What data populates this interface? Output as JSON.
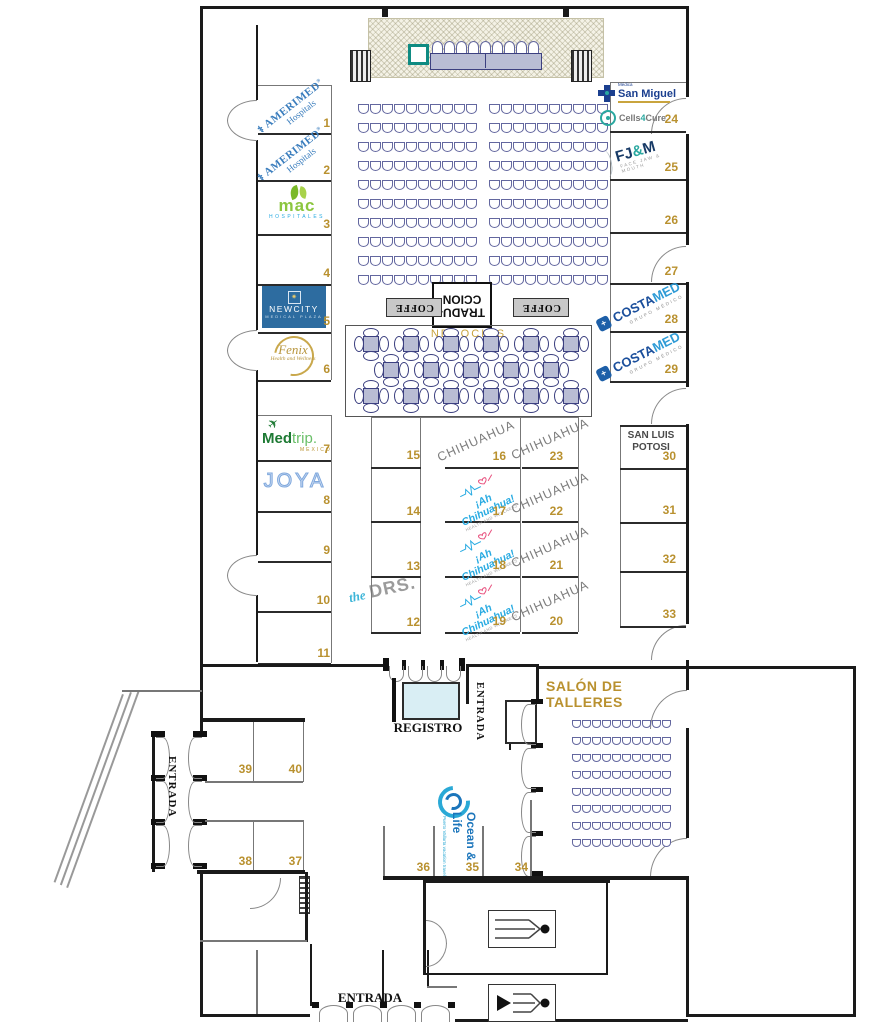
{
  "labels": {
    "entrada": "ENTRADA",
    "registro": "REGISTRO",
    "salon_talleres": "SALÓN DE TALLERES",
    "negocios": "NEGOCIOS",
    "tradu1": "TRADU-",
    "tradu2": "CCION",
    "coffe": "COFFE",
    "chihuahua": "CHIHUAHUA",
    "san_luis1": "SAN LUIS",
    "san_luis2": "POTOSI"
  },
  "logos": {
    "amerimed": {
      "name": "AMERIMED",
      "reg": "®",
      "sub": "Hospitals"
    },
    "mac": {
      "name": "mac",
      "sub": "HOSPITALES"
    },
    "newcity": {
      "name": "NEWCITY",
      "sub": "MEDICAL PLAZA"
    },
    "fenix": {
      "name": "Fenix",
      "sub": "Health and Wellness"
    },
    "medtrip": {
      "p1": "Med",
      "p2": "trip.",
      "sub": "MEXICO"
    },
    "joya": {
      "name": "JOYA"
    },
    "thedrs": {
      "p1": "the",
      "p2": "DRS."
    },
    "ah": {
      "name": "¡Ah Chihuahua!",
      "sub": "HEALTH AND WELLNESS"
    },
    "sanmiguel": {
      "pre": "Médica",
      "name": "San Miguel"
    },
    "cells": {
      "p1": "Cells",
      "p2": "4",
      "p3": "Cure"
    },
    "fjm": {
      "f": "FJ",
      "amp": "&",
      "m": "M",
      "sub": "FACE JAW & MOUTH"
    },
    "costamed": {
      "p1": "COSTA",
      "p2": "MED",
      "sub": "GRUPO MÉDICO",
      "ic": "+"
    },
    "oceanlife": {
      "name": "Ocean & Life",
      "sub": "Puerto Vallarta vacation travel"
    }
  },
  "booths": {
    "b1": {
      "num": "1",
      "exhibitor": "AMERIMED Hospitals"
    },
    "b2": {
      "num": "2",
      "exhibitor": "AMERIMED Hospitals"
    },
    "b3": {
      "num": "3",
      "exhibitor": "mac HOSPITALES"
    },
    "b4": {
      "num": "4",
      "exhibitor": ""
    },
    "b5": {
      "num": "5",
      "exhibitor": "NEWCITY MEDICAL PLAZA"
    },
    "b6": {
      "num": "6",
      "exhibitor": "Fenix Health and Wellness"
    },
    "b7": {
      "num": "7",
      "exhibitor": "Medtrip MEXICO"
    },
    "b8": {
      "num": "8",
      "exhibitor": "JOYA"
    },
    "b9": {
      "num": "9",
      "exhibitor": ""
    },
    "b10": {
      "num": "10",
      "exhibitor": ""
    },
    "b11": {
      "num": "11",
      "exhibitor": ""
    },
    "b12": {
      "num": "12",
      "exhibitor": "the DRS."
    },
    "b13": {
      "num": "13",
      "exhibitor": ""
    },
    "b14": {
      "num": "14",
      "exhibitor": ""
    },
    "b15": {
      "num": "15",
      "exhibitor": ""
    },
    "b16": {
      "num": "16",
      "exhibitor": "CHIHUAHUA"
    },
    "b17": {
      "num": "17",
      "exhibitor": "¡Ah Chihuahua! HEALTH AND WELLNESS"
    },
    "b18": {
      "num": "18",
      "exhibitor": "¡Ah Chihuahua! HEALTH AND WELLNESS"
    },
    "b19": {
      "num": "19",
      "exhibitor": "¡Ah Chihuahua! HEALTH AND WELLNESS"
    },
    "b20": {
      "num": "20",
      "exhibitor": "CHIHUAHUA"
    },
    "b21": {
      "num": "21",
      "exhibitor": "CHIHUAHUA"
    },
    "b22": {
      "num": "22",
      "exhibitor": "CHIHUAHUA"
    },
    "b23": {
      "num": "23",
      "exhibitor": "CHIHUAHUA"
    },
    "b24": {
      "num": "24",
      "exhibitor": "Médica San Miguel / Cells4Cure"
    },
    "b25": {
      "num": "25",
      "exhibitor": "FJ&M FACE JAW & MOUTH"
    },
    "b26": {
      "num": "26",
      "exhibitor": ""
    },
    "b27": {
      "num": "27",
      "exhibitor": ""
    },
    "b28": {
      "num": "28",
      "exhibitor": "COSTAMED GRUPO MÉDICO"
    },
    "b29": {
      "num": "29",
      "exhibitor": "COSTAMED GRUPO MÉDICO"
    },
    "b30": {
      "num": "30",
      "exhibitor": "SAN LUIS POTOSI"
    },
    "b31": {
      "num": "31",
      "exhibitor": ""
    },
    "b32": {
      "num": "32",
      "exhibitor": ""
    },
    "b33": {
      "num": "33",
      "exhibitor": ""
    },
    "b34": {
      "num": "34",
      "exhibitor": ""
    },
    "b35": {
      "num": "35",
      "exhibitor": "Ocean & Life Puerto Vallarta"
    },
    "b36": {
      "num": "36",
      "exhibitor": ""
    },
    "b37": {
      "num": "37",
      "exhibitor": ""
    },
    "b38": {
      "num": "38",
      "exhibitor": ""
    },
    "b39": {
      "num": "39",
      "exhibitor": ""
    },
    "b40": {
      "num": "40",
      "exhibitor": ""
    }
  },
  "seating": {
    "auditorium_left": {
      "rows": 10,
      "per_row": 10
    },
    "auditorium_right": {
      "rows": 10,
      "per_row": 10
    },
    "salon": {
      "rows": 8,
      "per_row": 10
    },
    "head_table": {
      "rows": 1,
      "per_row": 9
    },
    "negocios": {
      "rows": [
        6,
        5,
        6
      ]
    }
  },
  "colors": {
    "booth_number": "#b9912f",
    "chair_outline": "#63679f",
    "wall": "#1a1a1a",
    "table_fill": "#b9bdd4",
    "registro_fill": "#d9eef4",
    "podium_teal": "#0f8b82",
    "gold_text": "#b9912f"
  }
}
